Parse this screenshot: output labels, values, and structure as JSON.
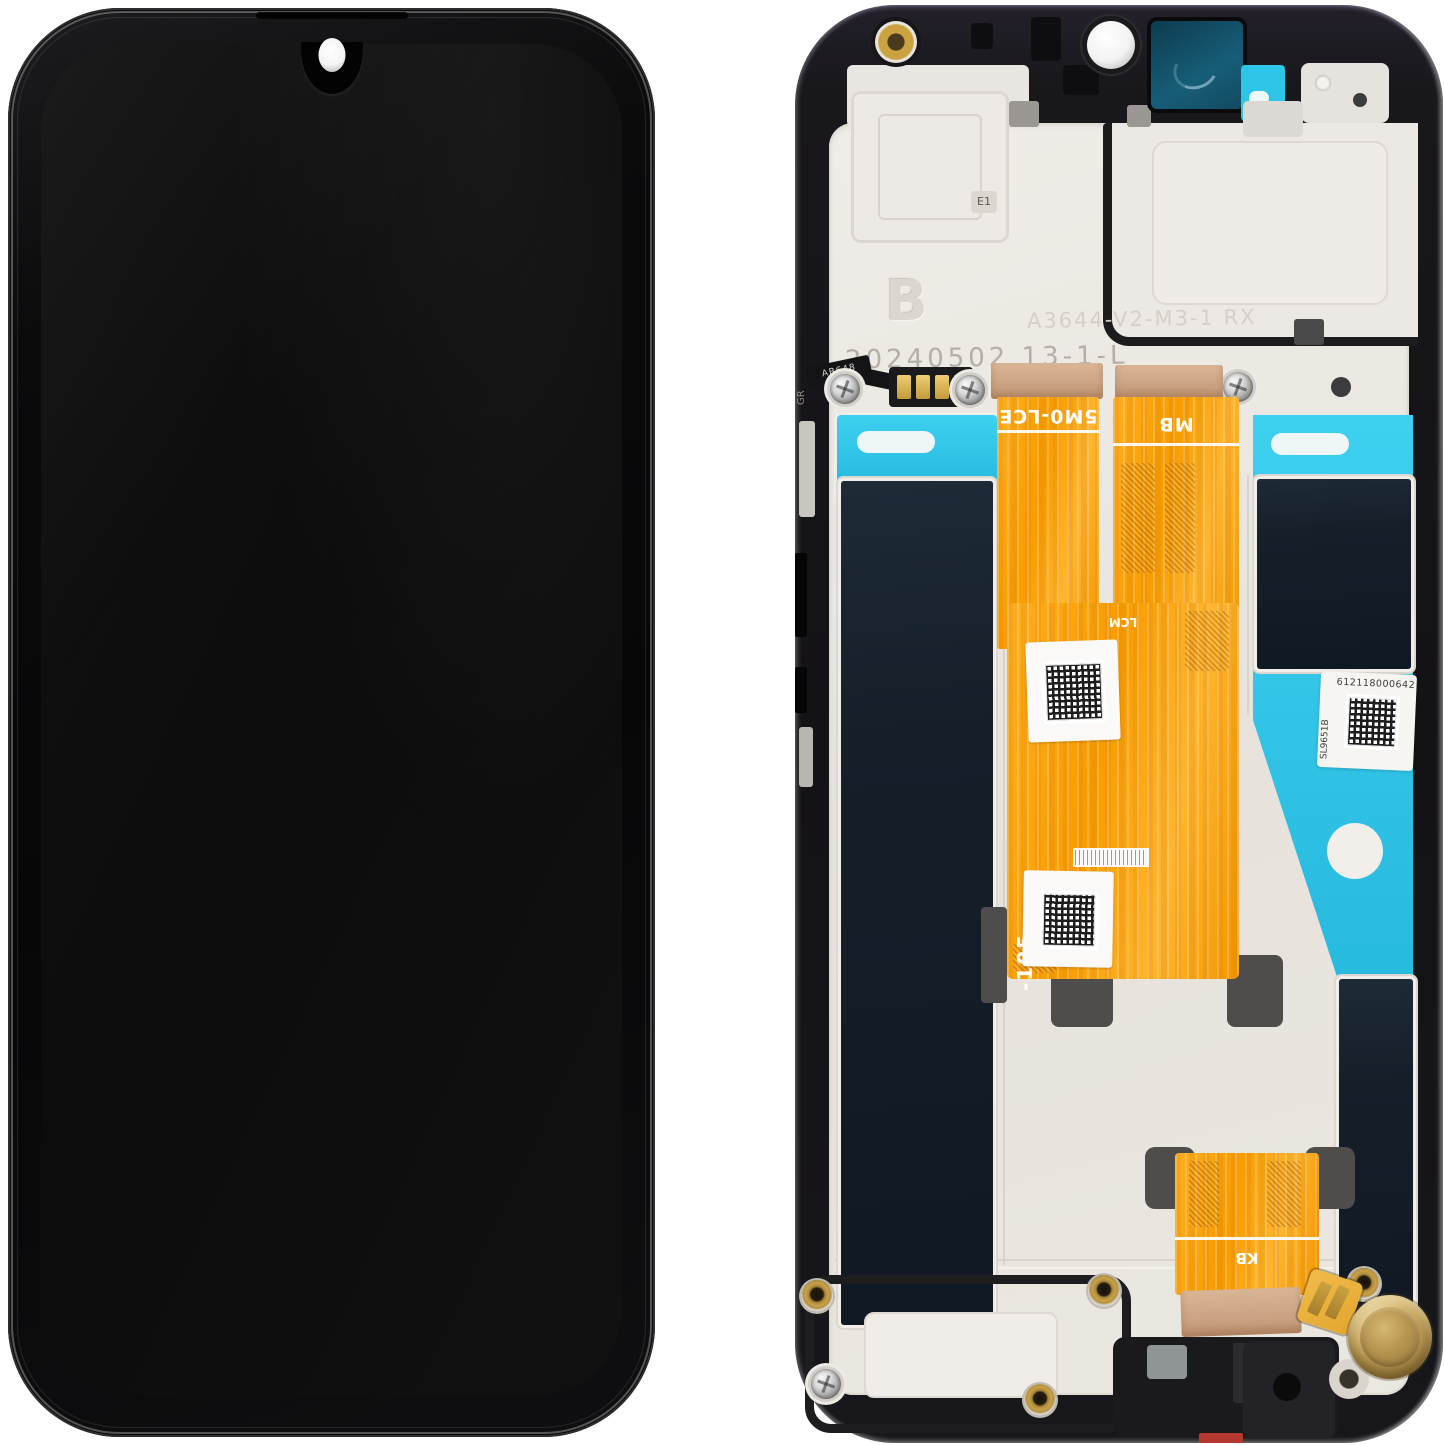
{
  "scene": {
    "type": "product-photo",
    "subject": "Phone LCD display assembly with frame — front glass view and back module view"
  },
  "front": {},
  "back": {
    "stamps": {
      "batch_letter": "B",
      "mold_mark": "E1",
      "part_number": "A3644-V2-M3-1 RX",
      "date_code": "20240502 13-1-L",
      "flex_code": "AB648",
      "frame_mark": "GR"
    },
    "flex": {
      "main": "5M0-LCE",
      "mb": "MB",
      "lcm": "LCM",
      "fpc": "FPC",
      "kb": "KB",
      "side_code": "-105"
    },
    "service_label": {
      "serial": "612118000642",
      "model": "SL9651B"
    },
    "colors": {
      "flex_orange": "#F89C00",
      "adhesive_cyan": "#2BC5E9",
      "panel_navy": "#141E29",
      "stiffener_bronze": "#CDA481",
      "camera_teal": "#155C78",
      "motor_gold": "#C2A05C",
      "plate": "#E9E6E1",
      "frame": "#161519"
    }
  }
}
